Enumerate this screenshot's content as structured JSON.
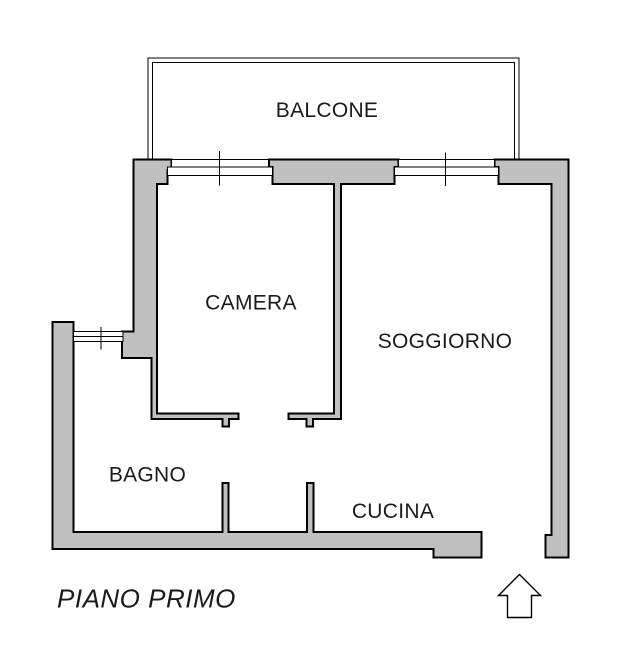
{
  "colors": {
    "background": "#ffffff",
    "wall_fill": "#c0c0c0",
    "outline": "#000000",
    "text": "#1a1a1a"
  },
  "plan": {
    "type": "apartment floor plan",
    "rooms": [
      {
        "id": "balcone",
        "label": "BALCONE"
      },
      {
        "id": "camera",
        "label": "CAMERA"
      },
      {
        "id": "soggiorno",
        "label": "SOGGIORNO"
      },
      {
        "id": "bagno",
        "label": "BAGNO"
      },
      {
        "id": "cucina",
        "label": "CUCINA"
      }
    ],
    "floor_label": "PIANO PRIMO",
    "icons": {
      "entrance_arrow": "up-arrow"
    }
  }
}
